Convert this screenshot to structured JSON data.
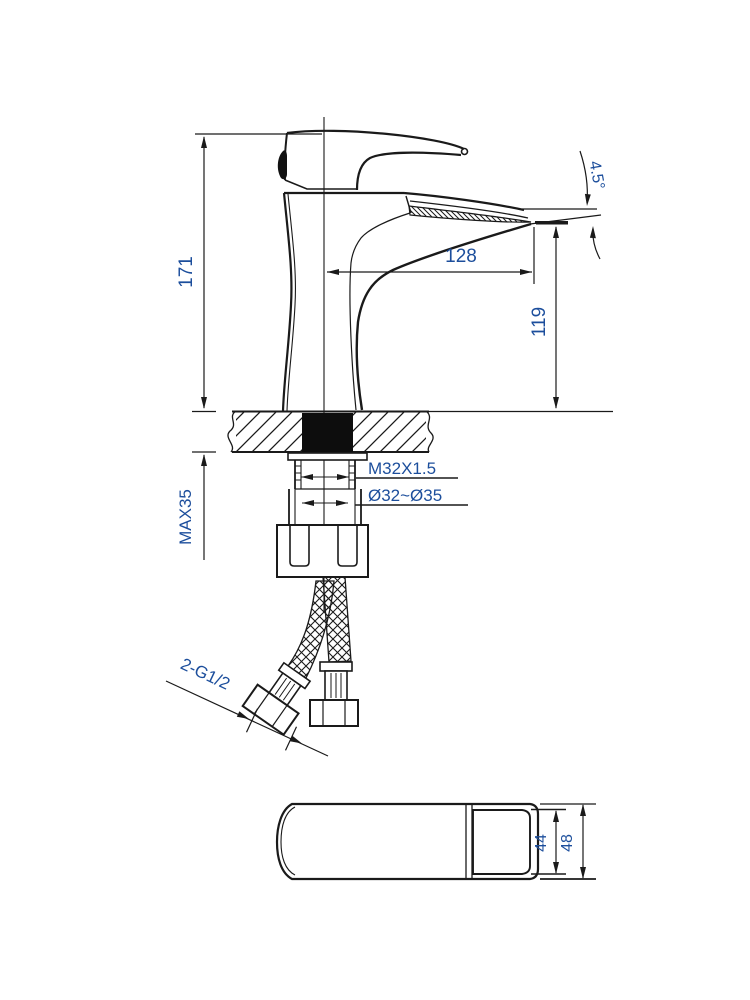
{
  "page": {
    "background": "#ffffff"
  },
  "drawing": {
    "title": "faucet-installation-dimension-drawing",
    "colors": {
      "line": "#1a1a1a",
      "dimension_text": "#1c4e9c"
    },
    "views": {
      "side": {
        "dims": {
          "overall_height": "171",
          "spout_reach": "128",
          "outlet_height": "119",
          "outlet_angle": "4.5°",
          "max_deck_thickness": "MAX35",
          "shank_thread": "M32X1.5",
          "mounting_hole": "Ø32~Ø35",
          "hose_connection": "2-G1/2"
        }
      },
      "top": {
        "dims": {
          "inner_width": "44",
          "outer_width": "48"
        }
      }
    }
  }
}
